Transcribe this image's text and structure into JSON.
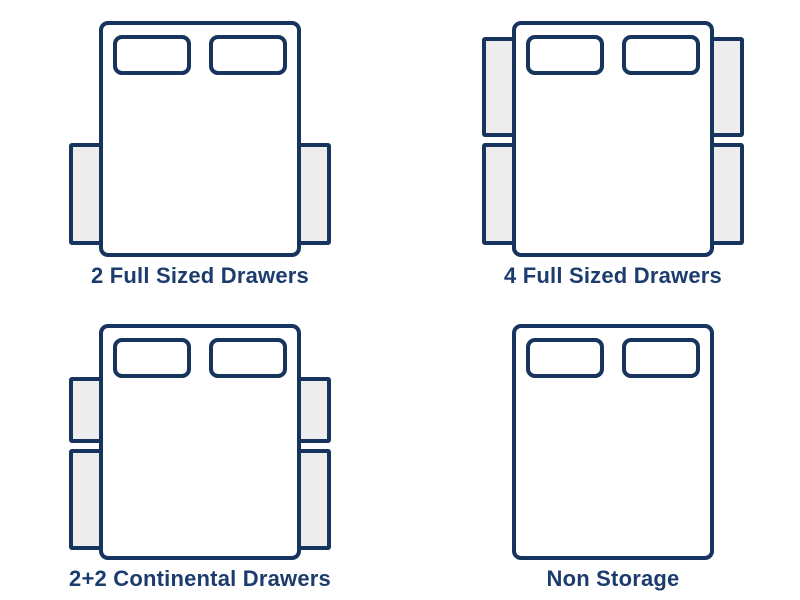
{
  "colors": {
    "outline": "#17345E",
    "label": "#1D3C6E",
    "drawer_fill": "#EDEDEE",
    "bed_fill": "#FFFFFF",
    "background": "#FFFFFF"
  },
  "figure": {
    "bed": {
      "x": 101,
      "y": 23,
      "w": 198,
      "h": 232,
      "corner_radius": 7,
      "stroke_width": 4
    },
    "pillows": {
      "dx_left": 14,
      "dx_right": 110,
      "dy": 14,
      "w": 74,
      "h": 36,
      "corner_radius": 7,
      "stroke_width": 4
    },
    "drawer": {
      "depth": 30,
      "stroke_width": 4,
      "corner_radius": 1
    },
    "drawer_slots": {
      "full_top": {
        "dy": 16,
        "h": 96
      },
      "full_bottom": {
        "dy": 122,
        "h": 98
      },
      "continental_top": {
        "dy": 53,
        "h": 62
      },
      "continental_bottom": {
        "dy": 125,
        "h": 97
      }
    }
  },
  "diagrams": [
    {
      "label": "2 Full Sized Drawers",
      "drawers": [
        {
          "side": "left",
          "slot": "full_bottom"
        },
        {
          "side": "right",
          "slot": "full_bottom"
        }
      ]
    },
    {
      "label": "4 Full Sized Drawers",
      "drawers": [
        {
          "side": "left",
          "slot": "full_top"
        },
        {
          "side": "left",
          "slot": "full_bottom"
        },
        {
          "side": "right",
          "slot": "full_top"
        },
        {
          "side": "right",
          "slot": "full_bottom"
        }
      ]
    },
    {
      "label": "2+2 Continental Drawers",
      "drawers": [
        {
          "side": "left",
          "slot": "continental_top"
        },
        {
          "side": "left",
          "slot": "continental_bottom"
        },
        {
          "side": "right",
          "slot": "continental_top"
        },
        {
          "side": "right",
          "slot": "continental_bottom"
        }
      ]
    },
    {
      "label": "Non Storage",
      "drawers": []
    }
  ]
}
